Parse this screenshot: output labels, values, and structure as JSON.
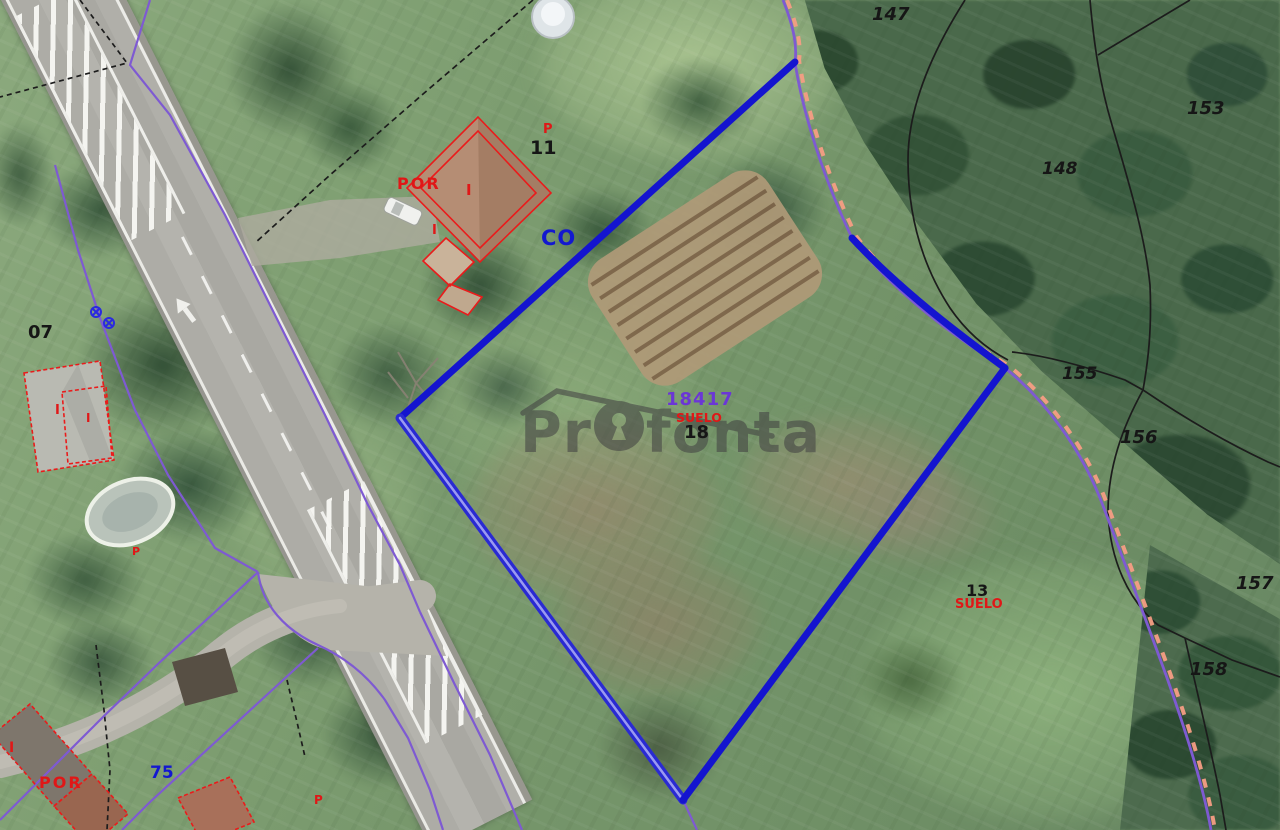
{
  "map_type": "aerial-cadastral-orthophoto",
  "watermark": {
    "pre": "Pr",
    "mid": "fon",
    "end": "ta"
  },
  "labels": {
    "blue": {
      "co": "CO",
      "n75": "75"
    },
    "violet_ref": "18417",
    "black": {
      "n07": "07",
      "n11": "11",
      "n18": "18",
      "n13": "13",
      "n147": "147",
      "n148": "148",
      "n153": "153",
      "n155": "155",
      "n156": "156",
      "n157": "157",
      "n158": "158"
    },
    "red": {
      "por_top": "POR",
      "i_top": "I",
      "i_top2": "I",
      "p_top": "P",
      "i_left": "I",
      "i_left2": "I",
      "p_pool": "P",
      "suelo_center": "SUELO",
      "suelo_right": "SUELO",
      "i_bottom": "I",
      "por_bottom": "POR",
      "p_bottom": "P"
    }
  },
  "colors": {
    "parcel_highlight_blue": "#1414cf",
    "cadastral_purple": "#7e5ad2",
    "boundary_pink_dash": "#f59d84",
    "building_outline_red": "#ea1b1b",
    "black_boundary": "#1c1c1c",
    "violet_ref_text": "#6b36d6",
    "blue_label_text": "#1318d0",
    "watermark_gray": "#434343"
  }
}
